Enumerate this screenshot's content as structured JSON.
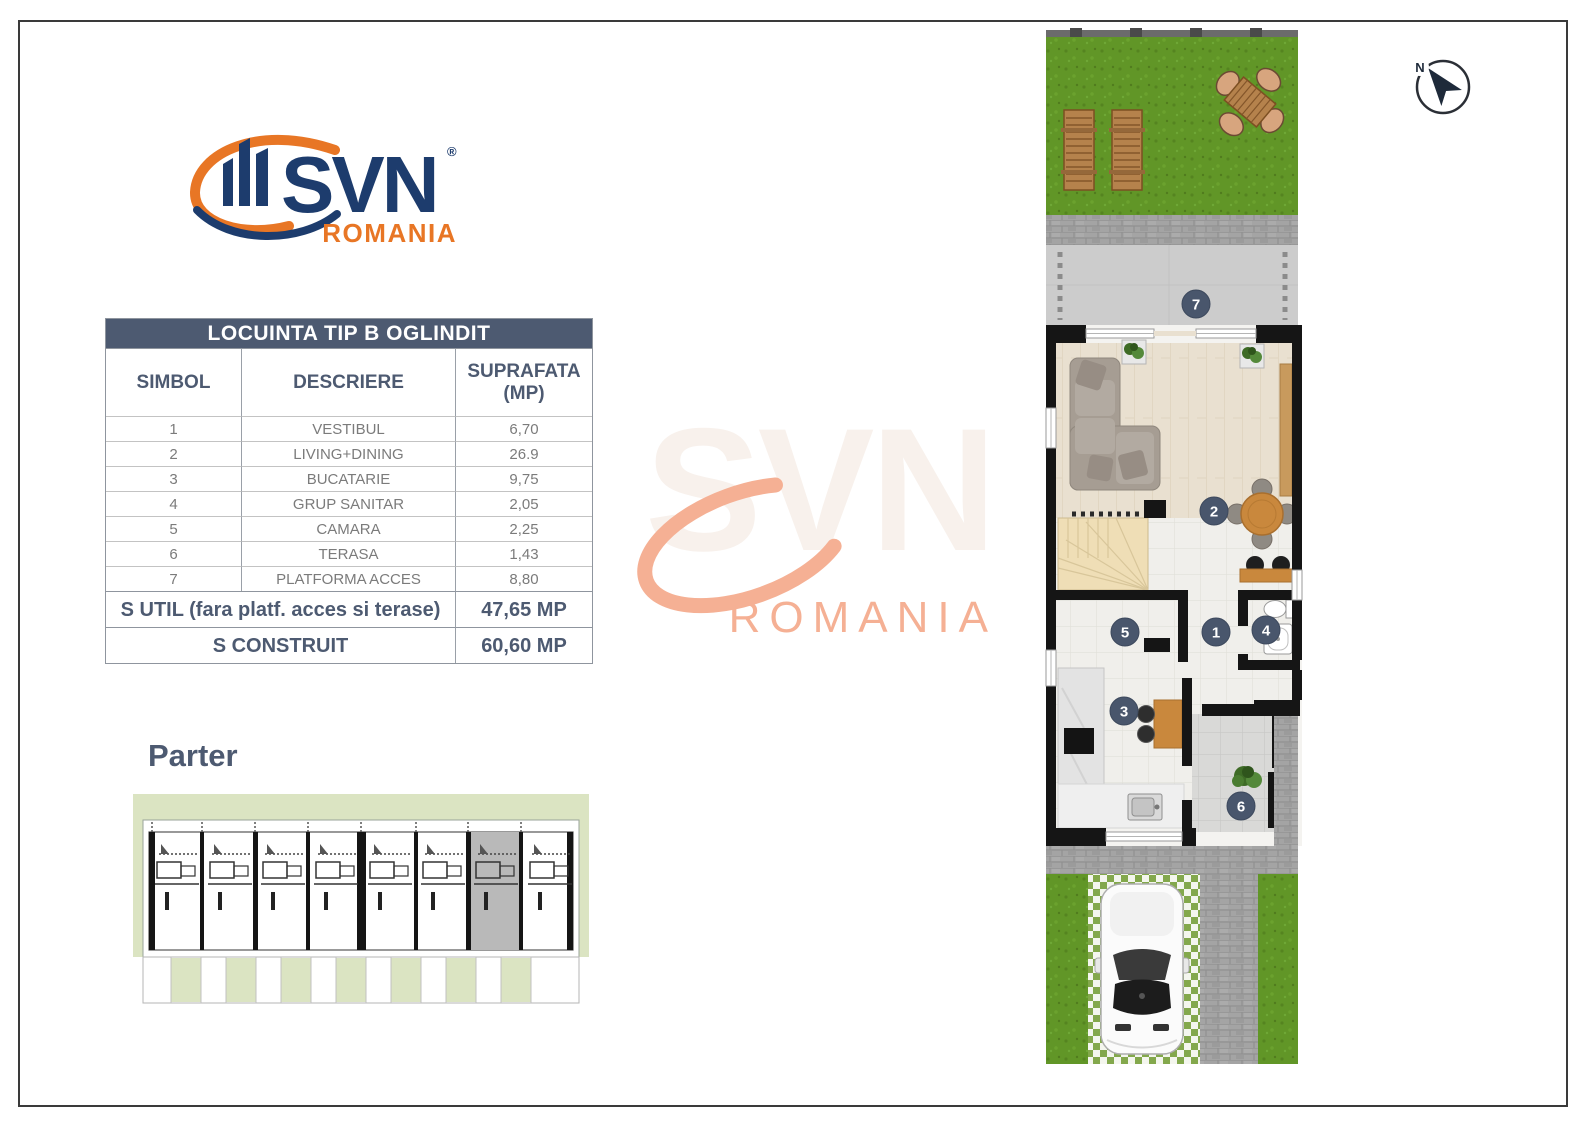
{
  "logo": {
    "brand": "SVN",
    "reg": "®",
    "region": "ROMANIA"
  },
  "compass": {
    "label": "N"
  },
  "table": {
    "title": "LOCUINTA TIP B OGLINDIT",
    "headers": {
      "simbol": "SIMBOL",
      "descriere": "DESCRIERE",
      "suprafata": "SUPRAFATA",
      "suprafata_unit": "(MP)"
    },
    "rows": [
      {
        "simbol": "1",
        "descriere": "VESTIBUL",
        "suprafata": "6,70"
      },
      {
        "simbol": "2",
        "descriere": "LIVING+DINING",
        "suprafata": "26.9"
      },
      {
        "simbol": "3",
        "descriere": "BUCATARIE",
        "suprafata": "9,75"
      },
      {
        "simbol": "4",
        "descriere": "GRUP SANITAR",
        "suprafata": "2,05"
      },
      {
        "simbol": "5",
        "descriere": "CAMARA",
        "suprafata": "2,25"
      },
      {
        "simbol": "6",
        "descriere": "TERASA",
        "suprafata": "1,43"
      },
      {
        "simbol": "7",
        "descriere": "PLATFORMA ACCES",
        "suprafata": "8,80"
      }
    ],
    "summary": [
      {
        "label": "S UTIL (fara platf. acces si terase)",
        "value": "47,65 MP"
      },
      {
        "label": "S CONSTRUIT",
        "value": "60,60 MP"
      }
    ]
  },
  "floor_label": "Parter",
  "watermark": {
    "brand": "SVN",
    "region": "ROMANIA"
  },
  "plan": {
    "markers": [
      {
        "label": "1"
      },
      {
        "label": "2"
      },
      {
        "label": "3"
      },
      {
        "label": "4"
      },
      {
        "label": "5"
      },
      {
        "label": "6"
      },
      {
        "label": "7"
      }
    ]
  },
  "colors": {
    "accent_slate": "#4d5a71",
    "navy": "#1d3c6d",
    "orange": "#e87625",
    "marker": "#49566c",
    "grass": "#619627",
    "watermark_salmon": "#f5b094",
    "wall_black": "#151515",
    "site_sage": "#dbe4c2"
  }
}
